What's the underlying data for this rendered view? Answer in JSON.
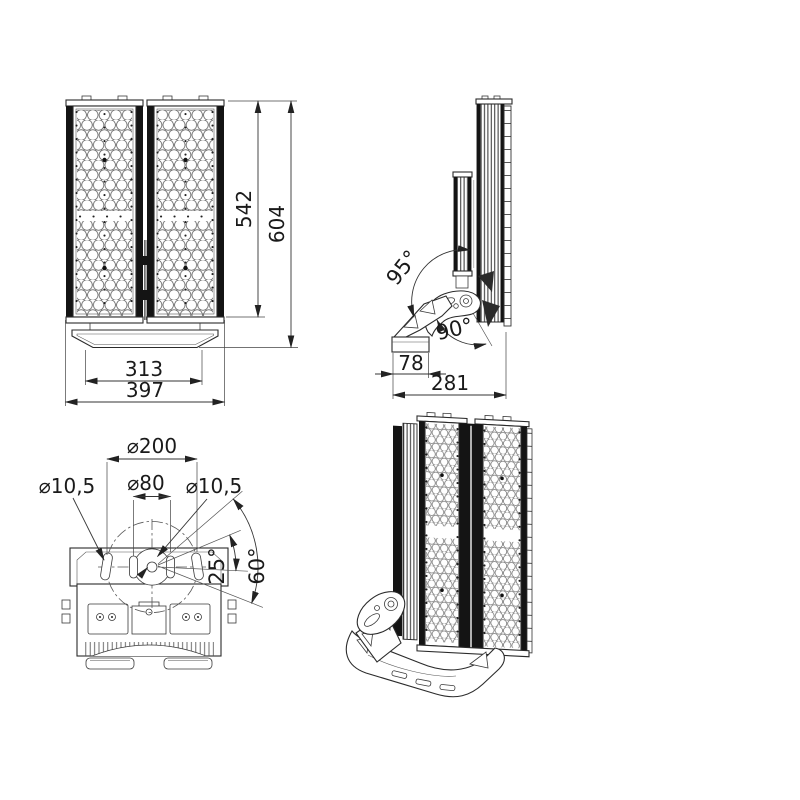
{
  "drawing": {
    "type": "technical-dimension-drawing",
    "subject": "LED floodlight luminaire, 4 views",
    "line_color": "#2b2b2b",
    "background": "#ffffff",
    "views": {
      "front": {
        "name": "front view",
        "dims": {
          "inner_height": "542",
          "outer_height": "604",
          "inner_width": "313",
          "outer_width": "397"
        }
      },
      "side": {
        "name": "side view",
        "dims": {
          "base_width": "78",
          "depth": "281"
        },
        "angles": {
          "tilt_up": "95°",
          "tilt_down": "90°"
        }
      },
      "bottom": {
        "name": "bottom / mounting view",
        "dims": {
          "bolt_circle": "⌀200",
          "center_hole": "⌀80",
          "left_hole": "⌀10,5",
          "right_hole": "⌀10,5"
        },
        "angles": {
          "small": "25°",
          "large": "60°"
        }
      },
      "iso": {
        "name": "isometric view"
      }
    }
  }
}
